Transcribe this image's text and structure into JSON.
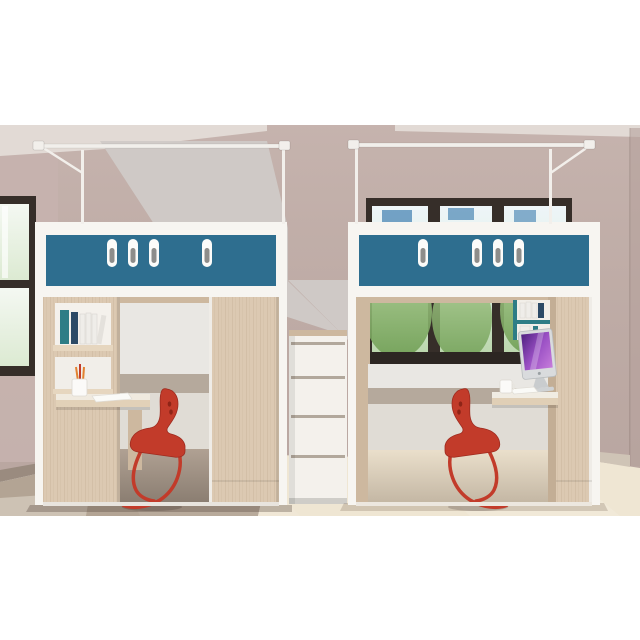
{
  "image": {
    "type": "3d-product-render",
    "subject": "Two loft beds with under-bed study desks, wardrobes and stair drawers in a dorm room",
    "background": "#ffffff"
  },
  "objects": {
    "left_unit": "loft bed with bookshelf desk on left, wardrobe door on right, red chair",
    "right_unit": "loft bed with window behind, desk computer on right, wardrobe on right, red chair",
    "stairs": "white stair drawer steps between the two units",
    "racks": "white clothes-drying rails mounted above both bunks",
    "room": "mauve walls, left side window, back window with trees, two-tone floor",
    "vent_slots_left": 4,
    "vent_slots_right": 4,
    "chairs": 2,
    "computer": "all-in-one desktop with purple screen",
    "desk_items": [
      "pencil cup",
      "papers",
      "mug",
      "books"
    ]
  },
  "palette": {
    "white": "#ffffff",
    "wall": "#bfaca7",
    "wall_side": "#c6b3ae",
    "ceiling": "#e2dad5",
    "light_wedge": "#d0cac7",
    "floor_left": "#b3a494",
    "floor_right": "#efe6d3",
    "baseboard": "#9a8b7f",
    "baseboard_right": "#cfc4b6",
    "wood": "#dcc9b2",
    "wood_shade": "#cdb89f",
    "white_trim": "#f7f5f1",
    "panel_teal": "#2e6e8f",
    "slot_white": "#fbfbf9",
    "slot_handle": "#8d8d8b",
    "interior_wall": "#e9e7e3",
    "interior_stripe": "#b5a99c",
    "interior_wall_low": "#e0dcd5",
    "window_frame": "#362e29",
    "glass_building": "#4a86b4",
    "chair_red": "#c23b2a",
    "chair_red_dark": "#9e2b1f",
    "imac_silver": "#d9dbdd",
    "stair_white": "#f4f1ec",
    "stair_gap": "#b2a89c",
    "rack_white": "#f2efeb",
    "book_teal": "#2e7d86",
    "book_navy": "#2c4a66",
    "book_white": "#efede9",
    "mug_white": "#fbfaf8",
    "pencil_orange": "#e2812f",
    "paper_white": "#fafaf7"
  }
}
